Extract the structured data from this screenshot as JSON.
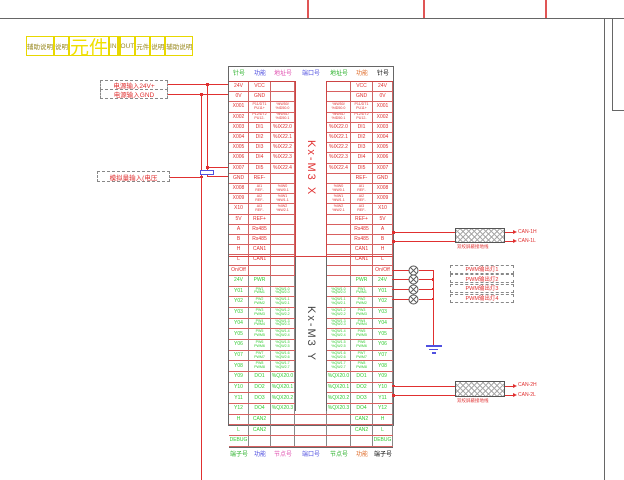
{
  "legend_strip": {
    "cells": [
      {
        "label": "辅助说明"
      },
      {
        "label": "说明"
      },
      {
        "label": "元件"
      },
      {
        "label": "IN"
      },
      {
        "label": ""
      },
      {
        "label": "OUT"
      },
      {
        "label": "元件"
      },
      {
        "label": "说明"
      },
      {
        "label": "辅助说明"
      }
    ]
  },
  "modules": {
    "x": "Kx-M3 X",
    "y": "Kx-M3 Y"
  },
  "connector": {
    "top_header": [
      {
        "label": "针号"
      },
      {
        "label": "功能"
      },
      {
        "label": "地址号"
      },
      {
        "label": "端口号"
      },
      {
        "label": "地址号"
      },
      {
        "label": "功能"
      },
      {
        "label": "针号"
      }
    ],
    "bottom_header": [
      {
        "label": "端子号"
      },
      {
        "label": "功能"
      },
      {
        "label": "节点号"
      },
      {
        "label": "端口号"
      },
      {
        "label": "节点号"
      },
      {
        "label": "功能"
      },
      {
        "label": "端子号"
      }
    ],
    "x_rows": [
      {
        "pin": "24V",
        "func": "VCC",
        "addr": ""
      },
      {
        "pin": "0V",
        "func": "GND",
        "addr": ""
      },
      {
        "pin": "X001",
        "func": "P11/DT1\nPU11+",
        "addr": "%IW50/\n%ID50.0"
      },
      {
        "pin": "X002",
        "func": "P12/DT2\nPU12-",
        "addr": "%IW51/\n%ID50.1"
      },
      {
        "pin": "X003",
        "func": "DI1",
        "addr": "%IX22.0"
      },
      {
        "pin": "X004",
        "func": "DI2",
        "addr": "%IX22.1"
      },
      {
        "pin": "X005",
        "func": "DI3",
        "addr": "%IX22.2"
      },
      {
        "pin": "X006",
        "func": "DI4",
        "addr": "%IX22.3"
      },
      {
        "pin": "X007",
        "func": "DI5",
        "addr": "%IX22.4"
      },
      {
        "pin": "GND",
        "func": "REF-",
        "addr": ""
      },
      {
        "pin": "X008",
        "func": "AI1\nREF-",
        "addr": "%IW0\n%IW0.1"
      },
      {
        "pin": "X009",
        "func": "AI2\nREF-",
        "addr": "%IW1\n%IW1.1"
      },
      {
        "pin": "X10",
        "func": "AI3\nREF-",
        "addr": "%IW2\n%IW2.1"
      },
      {
        "pin": "5V",
        "func": "REF+",
        "addr": ""
      },
      {
        "pin": "A",
        "func": "Rs485",
        "addr": ""
      },
      {
        "pin": "B",
        "func": "Rs485",
        "addr": ""
      },
      {
        "pin": "H",
        "func": "CAN1",
        "addr": ""
      },
      {
        "pin": "L",
        "func": "CAN1",
        "addr": ""
      },
      {
        "pin": "On/Off",
        "func": "",
        "addr": ""
      }
    ],
    "y_rows": [
      {
        "pin": "24V",
        "func": "PWR",
        "addr": ""
      },
      {
        "pin": "Y01",
        "func": "PW1\nPWM1",
        "addr": "%QW1.0\n%QW2.0"
      },
      {
        "pin": "Y02",
        "func": "PW2\nPWM2",
        "addr": "%QW1.1\n%QW2.1"
      },
      {
        "pin": "Y03",
        "func": "PW3\nPWM3",
        "addr": "%QW1.2\n%QW2.2"
      },
      {
        "pin": "Y04",
        "func": "PW4\nPWM4",
        "addr": "%QW1.3\n%QW2.3"
      },
      {
        "pin": "Y05",
        "func": "PW5\nPWM5",
        "addr": "%QW1.4\n%QW2.4"
      },
      {
        "pin": "Y06",
        "func": "PW6\nPWM6",
        "addr": "%QW1.5\n%QW2.5"
      },
      {
        "pin": "Y07",
        "func": "PW7\nPWM7",
        "addr": "%QW1.6\n%QW2.6"
      },
      {
        "pin": "Y08",
        "func": "PW8\nPWM8",
        "addr": "%QW1.7\n%QW2.7"
      },
      {
        "pin": "Y09",
        "func": "DO1",
        "addr": "%QX20.0"
      },
      {
        "pin": "Y10",
        "func": "DO2",
        "addr": "%QX20.1"
      },
      {
        "pin": "Y11",
        "func": "DO3",
        "addr": "%QX20.2"
      },
      {
        "pin": "Y12",
        "func": "DO4",
        "addr": "%QX20.3"
      },
      {
        "pin": "H",
        "func": "CAN2",
        "addr": ""
      },
      {
        "pin": "L",
        "func": "CAN2",
        "addr": ""
      },
      {
        "pin": "DEBUG",
        "func": "",
        "addr": ""
      }
    ]
  },
  "left_labels": {
    "power_24v": "电源输入24V+",
    "power_gnd": "电源输入GND",
    "analog_in": "模拟量输入(电压"
  },
  "right_side": {
    "can1": {
      "h_label": "CAN-1H",
      "l_label": "CAN-1L",
      "caption": "双绞屏蔽接地线"
    },
    "can2": {
      "h_label": "CAN-2H",
      "l_label": "CAN-2L",
      "caption": "双绞屏蔽接地线"
    },
    "pwm_labels": [
      {
        "label": "PWM输出灯1"
      },
      {
        "label": "PWM输出灯2"
      },
      {
        "label": "PWM输出灯3"
      },
      {
        "label": "PWM输出灯4"
      }
    ]
  },
  "colors": {
    "x_block": "#e03030",
    "y_block": "#33cc33",
    "address": "#5050e0",
    "port": "#e050b0",
    "pin_header": "#e07030",
    "legend": "#f0e000",
    "component": "#5050e0"
  }
}
